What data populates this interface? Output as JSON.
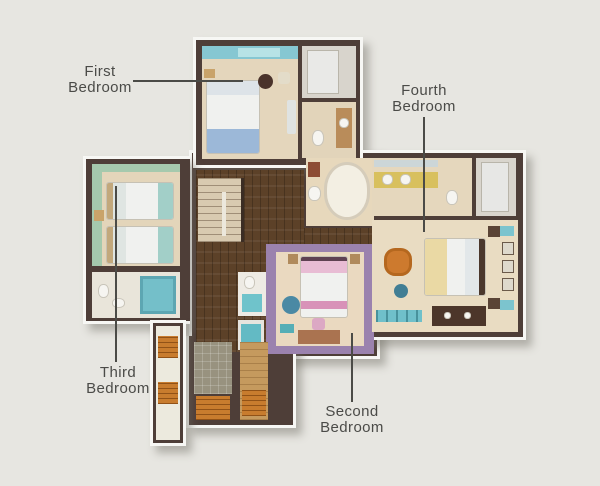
{
  "labels": {
    "first": {
      "line1": "First",
      "line2": "Bedroom"
    },
    "fourth": {
      "line1": "Fourth",
      "line2": "Bedroom"
    },
    "third": {
      "line1": "Third",
      "line2": "Bedroom"
    },
    "second": {
      "line1": "Second",
      "line2": "Bedroom"
    }
  },
  "colors": {
    "background": "#e7e6e1",
    "wall": "#4e3e38",
    "outline": "#f7f7f4",
    "label_text": "#4b4b48",
    "leader_line": "#4b4b47",
    "wood_floor": "#5c4128",
    "floor_beige": "#e8dac0",
    "first_bedroom_accent": "#86c7d2",
    "third_bedroom_accent": "#a5c9ad",
    "second_bedroom_accent": "#9b82ae",
    "fourth_bedroom_accent": "#cd7a2e",
    "bath_teal": "#74bfc9",
    "sauna_orange": "#c87c2e"
  }
}
